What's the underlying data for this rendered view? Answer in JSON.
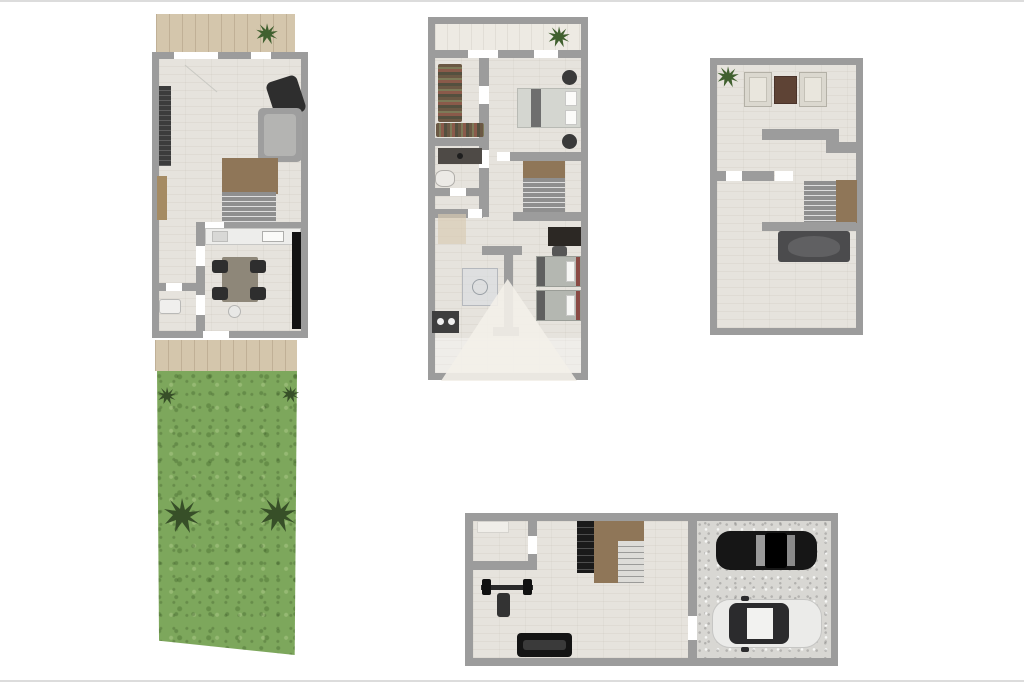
{
  "sheet": {
    "kind": "real-estate floor plan set",
    "background": "#ffffff",
    "plans": [
      {
        "id": "ground-floor",
        "features": [
          "terrace-with-plant",
          "living-room",
          "sofa",
          "radiator",
          "staircase",
          "wardrobe",
          "kitchen-dining",
          "dining-table-4-chairs",
          "kitchen-counter-sink",
          "tv-panel",
          "hallway",
          "wc"
        ]
      },
      {
        "id": "garden",
        "features": [
          "patio-strip",
          "lawn",
          "two-shrubs",
          "two-large-plants"
        ]
      },
      {
        "id": "first-floor",
        "features": [
          "balcony-with-plant",
          "walk-in-closet",
          "vanity",
          "toilet",
          "master-bedroom-double-bed",
          "two-nightstands",
          "staircase",
          "desk",
          "two-single-beds",
          "shower",
          "bathroom-sink",
          "hall"
        ]
      },
      {
        "id": "attic",
        "features": [
          "sitting-area-two-armchairs",
          "coffee-table",
          "plant",
          "staircase",
          "double-bed"
        ]
      },
      {
        "id": "basement",
        "features": [
          "storage-room",
          "shelf",
          "staircase",
          "barbell-gym",
          "gym-bench",
          "workout-bench",
          "garage-two-cars"
        ]
      }
    ],
    "cars": [
      {
        "position": "top",
        "color_name": "black",
        "hex": "#161616"
      },
      {
        "position": "bottom",
        "color_name": "white",
        "hex": "#ebebe9"
      }
    ],
    "watermark": {
      "shape": "pyramid-triangle",
      "hex": "#f3f0e9"
    }
  },
  "colors": {
    "wall": "#9c9c9c",
    "floor": "#e6e3dd",
    "floor_light": "#edeae3",
    "deck": "#d4c6ac",
    "grass": "#7da75c",
    "brown": "#8f7658",
    "wood": "#a58b63",
    "dark": "#1a1a1a",
    "gray_sofa": "#9e9e9e",
    "chair_dark": "#2e2e2e",
    "mattress": "#d4d6d0",
    "bed_dark": "#4b4b4d",
    "red": "#8a4a44",
    "plant": "#40602f",
    "plant_dark": "#374f28",
    "tablebrown": "#5e4335",
    "garage": "#d8d7d3",
    "car_black": "#161616",
    "car_white": "#ebebe9",
    "wm": "#f3f0e9",
    "frame": "#dcdcdc",
    "counter": "#ededeb",
    "tan": "#d9cbb2",
    "steps": "#8f8f8f"
  }
}
